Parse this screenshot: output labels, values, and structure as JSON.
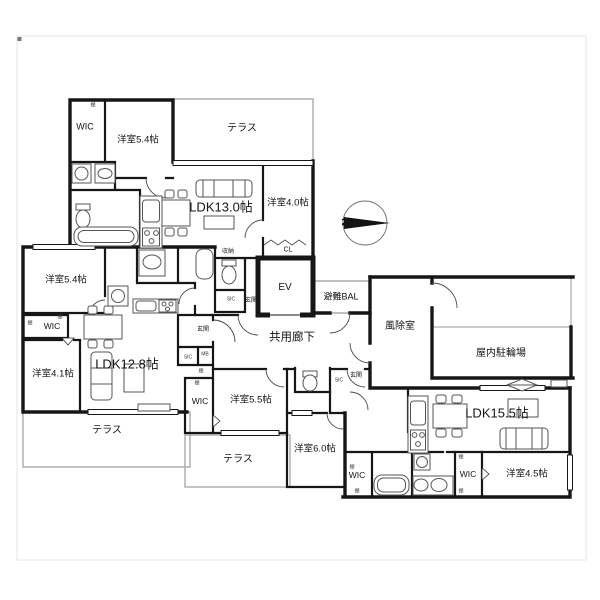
{
  "compass": {
    "label": "N"
  },
  "misc": {
    "shelf": "棚"
  },
  "rooms": [
    {
      "id": "wic-a",
      "label": "WIC"
    },
    {
      "id": "bedroom-54-a",
      "label": "洋室5.4帖"
    },
    {
      "id": "terrace-a",
      "label": "テラス"
    },
    {
      "id": "ldk-13",
      "label": "LDK13.0帖"
    },
    {
      "id": "bedroom-40",
      "label": "洋室4.0帖"
    },
    {
      "id": "closet-cl",
      "label": "CL"
    },
    {
      "id": "storage-a",
      "label": "収納"
    },
    {
      "id": "elevator",
      "label": "EV"
    },
    {
      "id": "evac-balcony",
      "label": "避難BAL"
    },
    {
      "id": "corridor",
      "label": "共用廊下"
    },
    {
      "id": "windbreak",
      "label": "風除室"
    },
    {
      "id": "bike-parking",
      "label": "屋内駐輪場"
    },
    {
      "id": "entry-a",
      "label": "玄関"
    },
    {
      "id": "sic-a",
      "label": "SIC"
    },
    {
      "id": "bedroom-54-b",
      "label": "洋室5.4帖"
    },
    {
      "id": "wic-b",
      "label": "WIC"
    },
    {
      "id": "bedroom-41",
      "label": "洋室4.1帖"
    },
    {
      "id": "ldk-128",
      "label": "LDK12.8帖"
    },
    {
      "id": "entry-b",
      "label": "玄関"
    },
    {
      "id": "sic-b",
      "label": "SIC"
    },
    {
      "id": "mail-box",
      "label": "MB"
    },
    {
      "id": "terrace-b",
      "label": "テラス"
    },
    {
      "id": "wic-c",
      "label": "WIC"
    },
    {
      "id": "bedroom-55",
      "label": "洋室5.5帖"
    },
    {
      "id": "terrace-c",
      "label": "テラス"
    },
    {
      "id": "bedroom-60",
      "label": "洋室6.0帖"
    },
    {
      "id": "entry-d",
      "label": "玄関"
    },
    {
      "id": "sic-d",
      "label": "SIC"
    },
    {
      "id": "wic-d2",
      "label": "WIC"
    },
    {
      "id": "wic-d",
      "label": "WIC"
    },
    {
      "id": "bedroom-45",
      "label": "洋室4.5帖"
    },
    {
      "id": "ldk-155",
      "label": "LDK15.5帖"
    }
  ],
  "colors": {
    "wall": "#161616",
    "thin": "#9a9a9a",
    "terrace": "#ababab"
  }
}
